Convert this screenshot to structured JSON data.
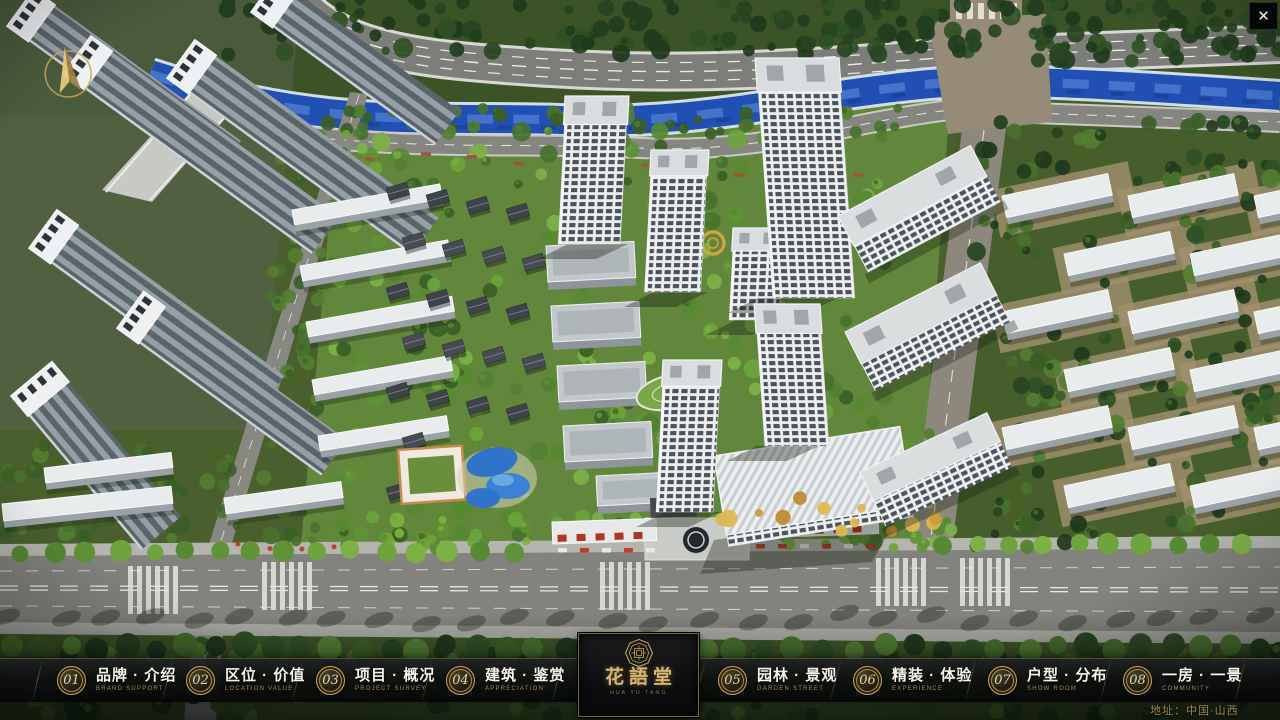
{
  "window": {
    "close_icon": "✕"
  },
  "nav": {
    "items": [
      {
        "num": "01",
        "label_cn": "品牌 · 介绍",
        "label_en": "BRAND SUPPORT"
      },
      {
        "num": "02",
        "label_cn": "区位 · 价值",
        "label_en": "LOCATION VALUE"
      },
      {
        "num": "03",
        "label_cn": "项目 · 概况",
        "label_en": "PROJECT SURVEY"
      },
      {
        "num": "04",
        "label_cn": "建筑 · 鉴赏",
        "label_en": "APPRECIATION"
      },
      {
        "num": "05",
        "label_cn": "园林 · 景观",
        "label_en": "GARDEN STREET"
      },
      {
        "num": "06",
        "label_cn": "精装 · 体验",
        "label_en": "EXPERIENCE"
      },
      {
        "num": "07",
        "label_cn": "户型 · 分布",
        "label_en": "SHOW ROOM"
      },
      {
        "num": "08",
        "label_cn": "一房 · 一景",
        "label_en": "COMMUNITY"
      }
    ],
    "logo": {
      "title": "花語堂",
      "subtitle": "HUA YU TANG"
    },
    "address": "地址：中国·山西"
  },
  "colors": {
    "gold": "#c9a557",
    "bar_background": "#0b0c0d"
  }
}
